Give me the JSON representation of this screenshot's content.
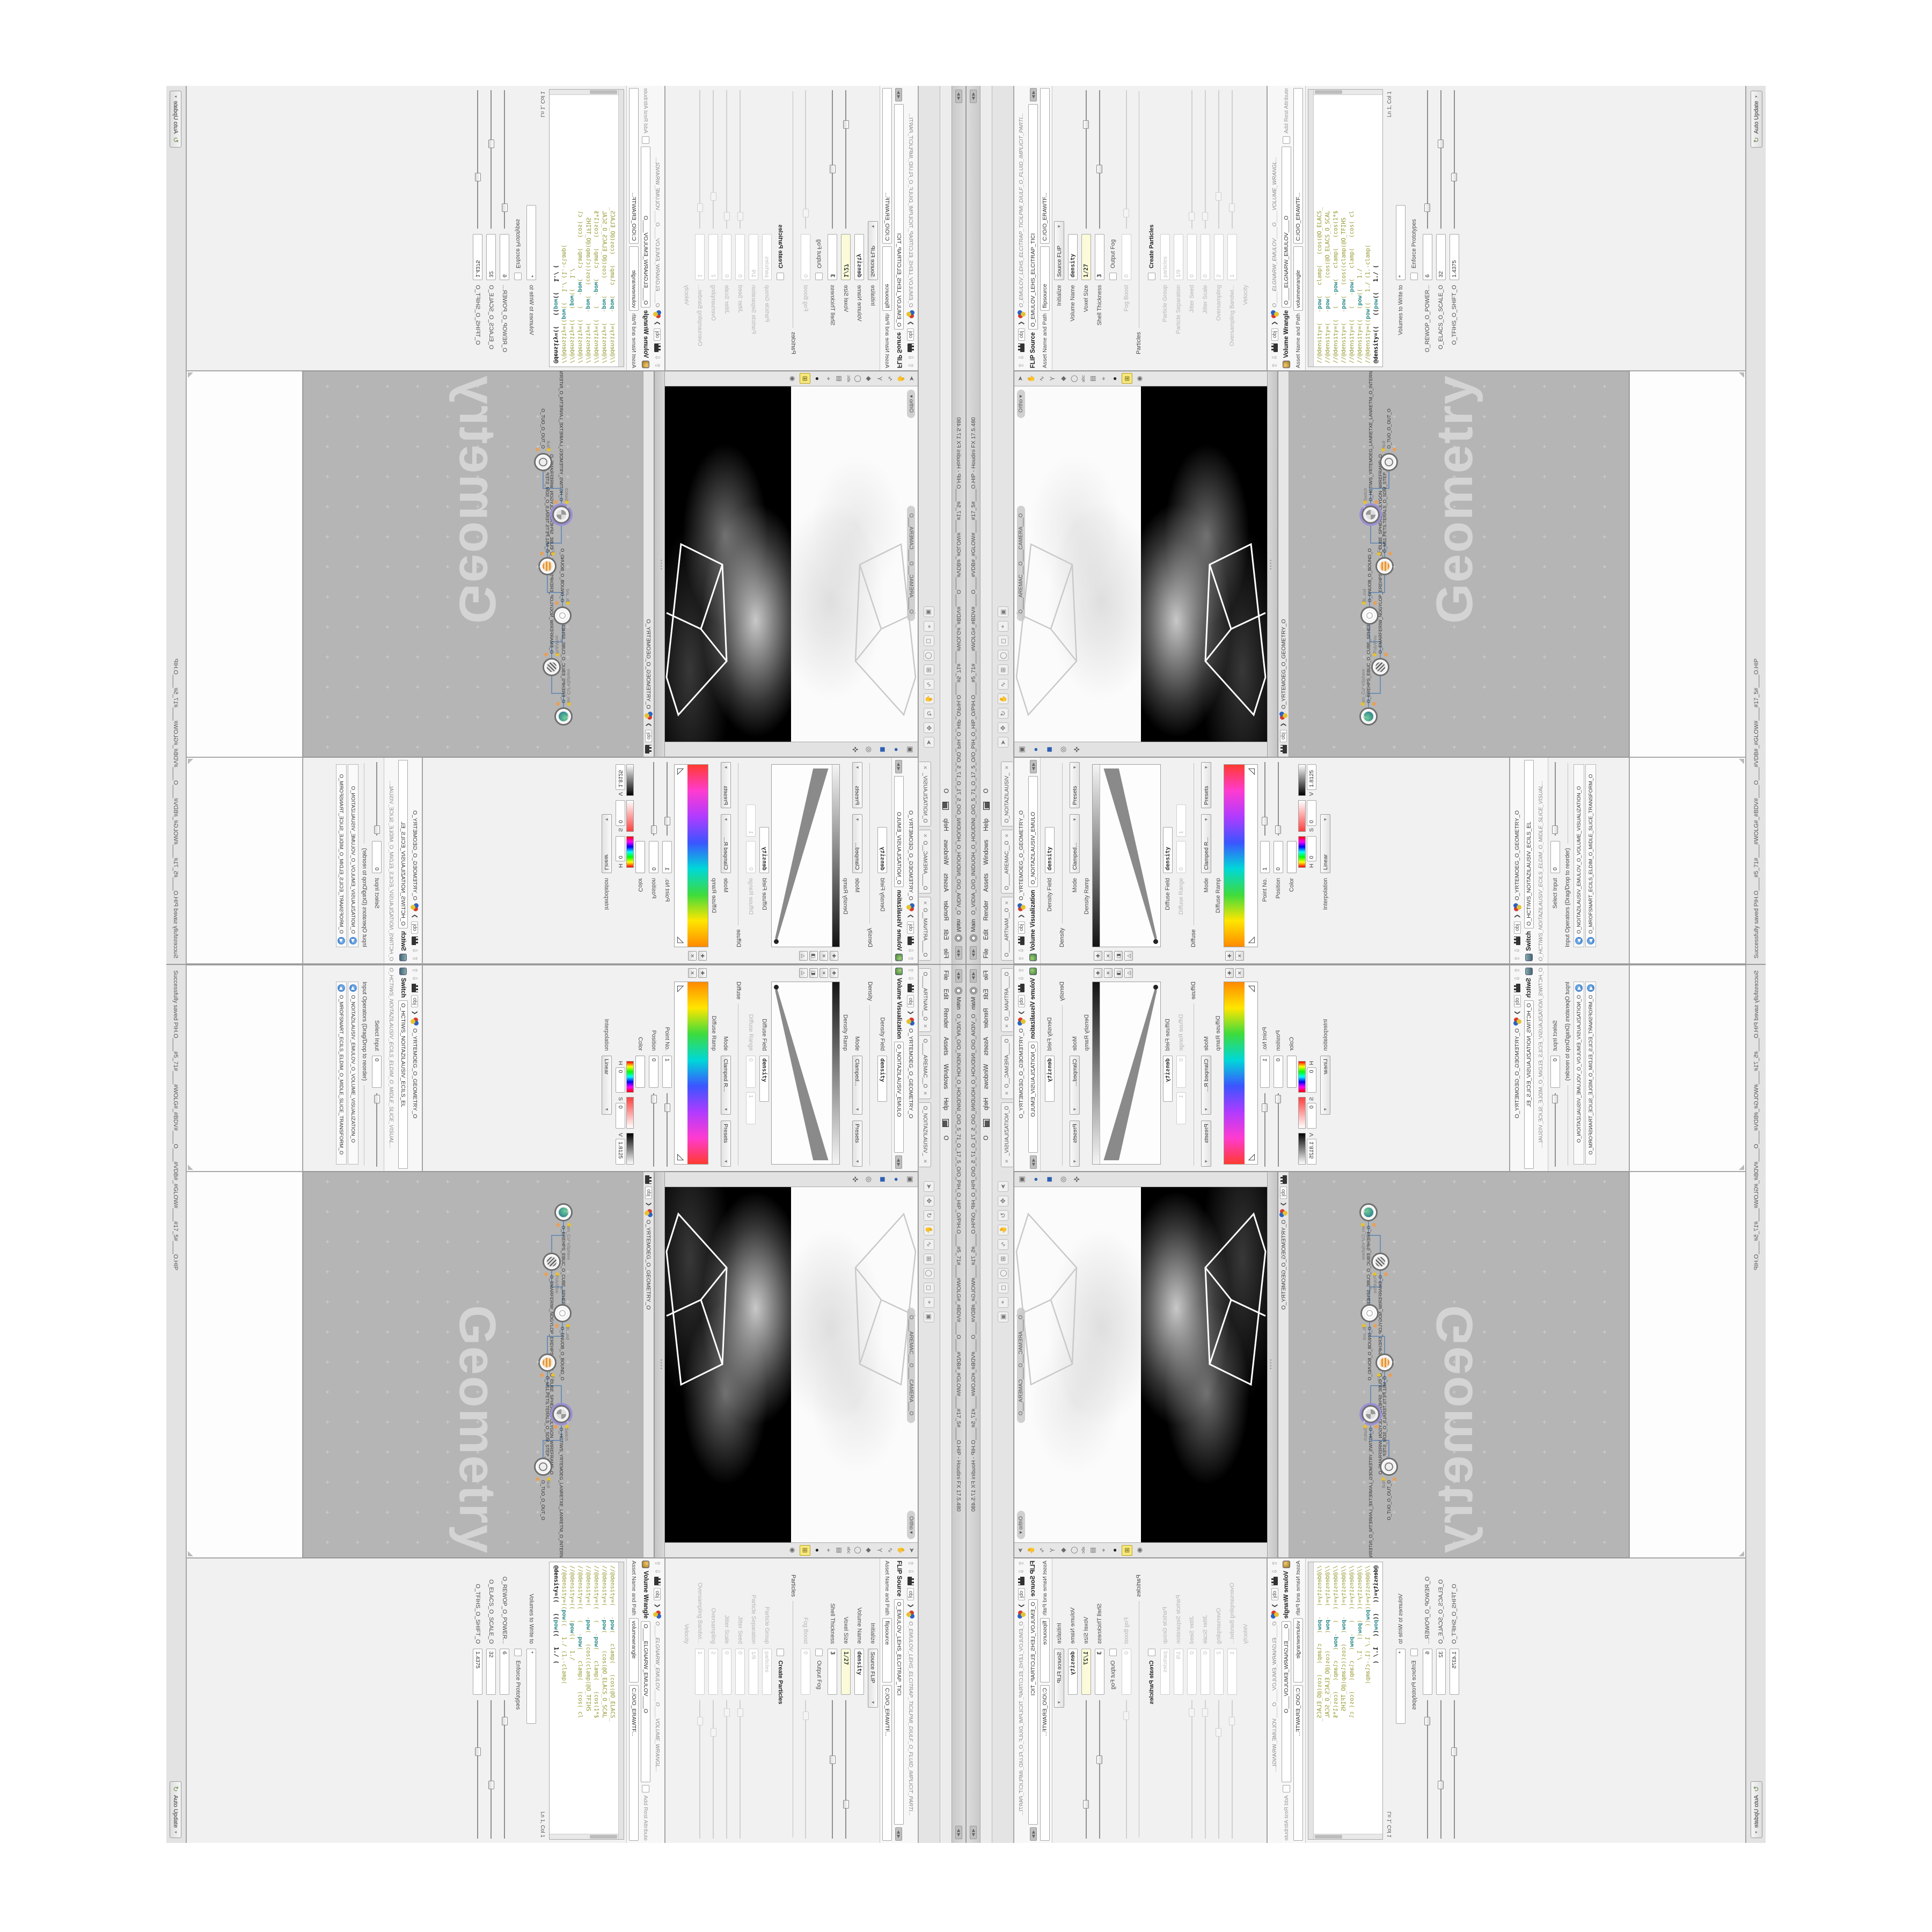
{
  "colors": {
    "accent_yellow": "#f6e87b",
    "node_purple": "#9b8fd4",
    "wire_blue": "#6f8fb4",
    "code_olive": "#97972f",
    "code_teal": "#2e8b8b",
    "network_bg": "#b5b5b5",
    "viewport_black": "#000000",
    "field_yellow": "#fbfbd9"
  },
  "window": {
    "title": "O_VIDIA_O/O_INIDUOH_O_HOUDINI_O/O_5_71_O_17_5_O/O_PIH_O_HIP_O/PIH.O____#5_71#____#WOLG#_#BDV#____O____#VDB#_#GLOW#____#17_5#____O.HIP - Houdini FX 17.5.480",
    "main_label": "Main",
    "menus": [
      "File",
      "Edit",
      "Render",
      "Assets",
      "Windows",
      "Help"
    ],
    "menu_extra": "O",
    "pane_tabs": [
      "O____ARTNAM__O",
      "O____AREMAC__O",
      "O_NOITAZILAUSIV_"
    ],
    "status_saved": "Successfully saved PIH.O____#5_71#____#WOLG#_#BDV#____O____#VDB#_#GLOW#____#17_5#____O.HIP",
    "update_mode": "Auto Update"
  },
  "viewport": {
    "camera_label": "O____AREMAC___O____CAMERA___O",
    "ortho_label": "Ortho",
    "obj_label": "obj",
    "geo_path": "O_YRTEMOEG_O_GEOMETRY_O"
  },
  "network": {
    "obj_label": "obj",
    "geo_path": "O_YRTEMOEG_O_GEOMETRY_O",
    "watermark": "Geometry",
    "nodes": [
      {
        "type": "sm_CubeSphere",
        "name": "O_EREHPS_EBUC_O_CUBE_SPHERE_O",
        "glyph": "globe",
        "purple": false
      },
      {
        "type": "PolyWire",
        "name": "O_EMARFERIW_NOGYLOP_EREHPS_EBUC_O_CUBE_SPHERE_POLYGON_WIREFRAME_O",
        "glyph": "wire",
        "purple": false
      },
      {
        "type": "Bound",
        "name": "O_DNUOB_O_BOUND_O",
        "glyph": "ring",
        "purple": false
      },
      {
        "type": "File",
        "name": "O_M51.PETS.TERALS_O_SDM_STEP_FILE_O",
        "glyph": "file",
        "purple": false
      },
      {
        "type": "Switch",
        "name": "O_HCTIWS_YRTEMOEG_LANRETXE_LANRETNI_O_INTERNAL_EXTERNAL_GEOMETRY_SWITCH_O",
        "glyph": "switch",
        "purple": true
      },
      {
        "type": "Null",
        "name": "O_TUO_O_OUT_O",
        "glyph": "null",
        "purple": false
      }
    ]
  },
  "flip": {
    "tab": "FLIP Source",
    "breadcrumb": "O_EMULOV_LEHS_ELCITRAP_TICILPMI_DIULF_O_FLUID_IMPLICIT_PARTI...",
    "obj_label": "obj",
    "asset_box": "O_EMULOV_LEHS_ELCITRAP_TICI",
    "asset_label": "Asset Name and Path",
    "asset_field": "flipsource",
    "asset_path": "C:/O/O_ERAWTF...",
    "rows": [
      {
        "label": "Initialize",
        "value": "Source FLIP",
        "type": "dropdown"
      },
      {
        "label": "Volume Name",
        "value": "density",
        "type": "field",
        "boldv": true
      },
      {
        "label": "Voxel Size",
        "value": "1/27",
        "type": "field",
        "yellow": true,
        "boldv": true,
        "slider": 72
      },
      {
        "label": "Shell Thickness",
        "value": "3",
        "type": "field",
        "boldv": true,
        "slider": 40
      },
      {
        "label": "Output Fog",
        "type": "check"
      },
      {
        "label": "Fog Boost",
        "value": "0",
        "type": "field",
        "dim": true,
        "slider": 8,
        "dims": true
      },
      {
        "label": "Particles",
        "type": "sep"
      },
      {
        "label": "Create Particles",
        "type": "check",
        "bold": true
      },
      {
        "label": "Particle Group",
        "value": "particles",
        "type": "field",
        "dim": true
      },
      {
        "label": "Particle Separation",
        "value": "1/9",
        "type": "field",
        "dim": true
      },
      {
        "label": "Jitter Seed",
        "value": "0",
        "type": "field",
        "dim": true,
        "slider": 6,
        "dims": true
      },
      {
        "label": "Jitter Scale",
        "value": "0",
        "type": "field",
        "dim": true,
        "slider": 6,
        "dims": true
      },
      {
        "label": "Oversampling",
        "value": "2",
        "type": "field",
        "dim": true,
        "slider": 20,
        "dims": true
      },
      {
        "label": "Oversampling Bandwi...",
        "value": "1",
        "type": "field",
        "dim": true,
        "slider": 12,
        "dims": true
      },
      {
        "label": "Velocity",
        "type": "labelonly",
        "dim": true
      }
    ]
  },
  "wrangle": {
    "tab": "Volume Wrangle",
    "breadcrumb": "O____ELGNARW_EMULOV____O____VOLUME_WRANGL...",
    "obj_label": "obj",
    "asset_box": "O____ELGNARW_EMULOV____O",
    "add_rest": "Add Rest Attribute",
    "asset_label": "Asset Name and Path",
    "asset_field": "volumewrangle",
    "asset_path": "C:/O/O_ERAWTF...",
    "code": [
      "//@density=(   -pow(   clamp(   (cos(@O_ELACS_",
      "//@density=(   -pow(     (cos(@O_ELACS_O_SCAL",
      "//@density=((   (   -pow(   clamp(   (cos(1*$",
      "//@density=(   -pow(   (cos((clamp(@O_TFIHS",
      "//@density=((   (   -pow(   clamp(   (cos( cl",
      "//@density=((   (pow((   1./",
      "//@density=((pow((   1./ (1.-clamp(",
      "@density=((   ((pow((   1./ ("
    ],
    "ln_col": "Ln 1, Col 1",
    "volumes_label": "Volumes to Write to",
    "volumes_value": "*",
    "enforce": "Enforce Prototypes",
    "params": [
      {
        "label": "O_REWOP_O_POWER...",
        "value": "6",
        "slider": 12
      },
      {
        "label": "O_ELACS_O_SCALE_O",
        "value": "32",
        "slider": 58
      },
      {
        "label": "O_TFIHS_O_SHIFT_O",
        "value": "1.4375",
        "slider": 34
      }
    ]
  },
  "volvis": {
    "tab": "Volume Visualization",
    "breadcrumb": "O_NOITAZILAUSIV_EMULO",
    "obj_label": "obj",
    "geo_path": "O_YRTEMOEG_O_GEOMETRY_O",
    "density_field_label": "Density Field",
    "density_field": "density",
    "mode_label": "Mode",
    "density_mode": "Clamped...",
    "density_section": "Density",
    "presets": "Presets",
    "density_ramp_label": "Density Ramp",
    "diffuse_field_label": "Diffuse Field",
    "diffuse_field": "density",
    "diffuse_range_label": "Diffuse Range",
    "diffuse_range_min": "0",
    "diffuse_range_max": "1",
    "diffuse_mode": "Clamped R...",
    "diffuse_section": "Diffuse",
    "diffuse_ramp_label": "Diffuse Ramp",
    "point_no_label": "Point No.",
    "point_no": "1",
    "position_label": "Position",
    "position": "0",
    "color_label": "Color",
    "h_label": "H",
    "h": "0",
    "s_label": "S",
    "s": "0",
    "v_label": "V",
    "v": "1.8125",
    "interp_label": "Interpolation",
    "interp": "Linear"
  },
  "switch": {
    "tab": "Switch",
    "breadcrumb": "O_HCTIWS_NOITAZILAUSIV_ECILS_ELDIM_O_MIDLE_SLICE_VISUAL...",
    "obj_label": "obj",
    "geo_path": "O_YRTEMOEG_O_GEOMETRY_O",
    "asset_box": "O_HCTIWS_NOITAZILAUSIV_ECILS_EL",
    "select_label": "Select Input",
    "select_value": "0",
    "operators_label": "Input Operators (Drag/Drop to reorder)",
    "operators": [
      "O_NOITAZILAUSIV_EMULOV_O_VOLUME_VISUALIZATION_O",
      "O_MROFSNART_ECILS_ELDIM_O_MIDLE_SLICE_TRANSFORM_O"
    ]
  }
}
